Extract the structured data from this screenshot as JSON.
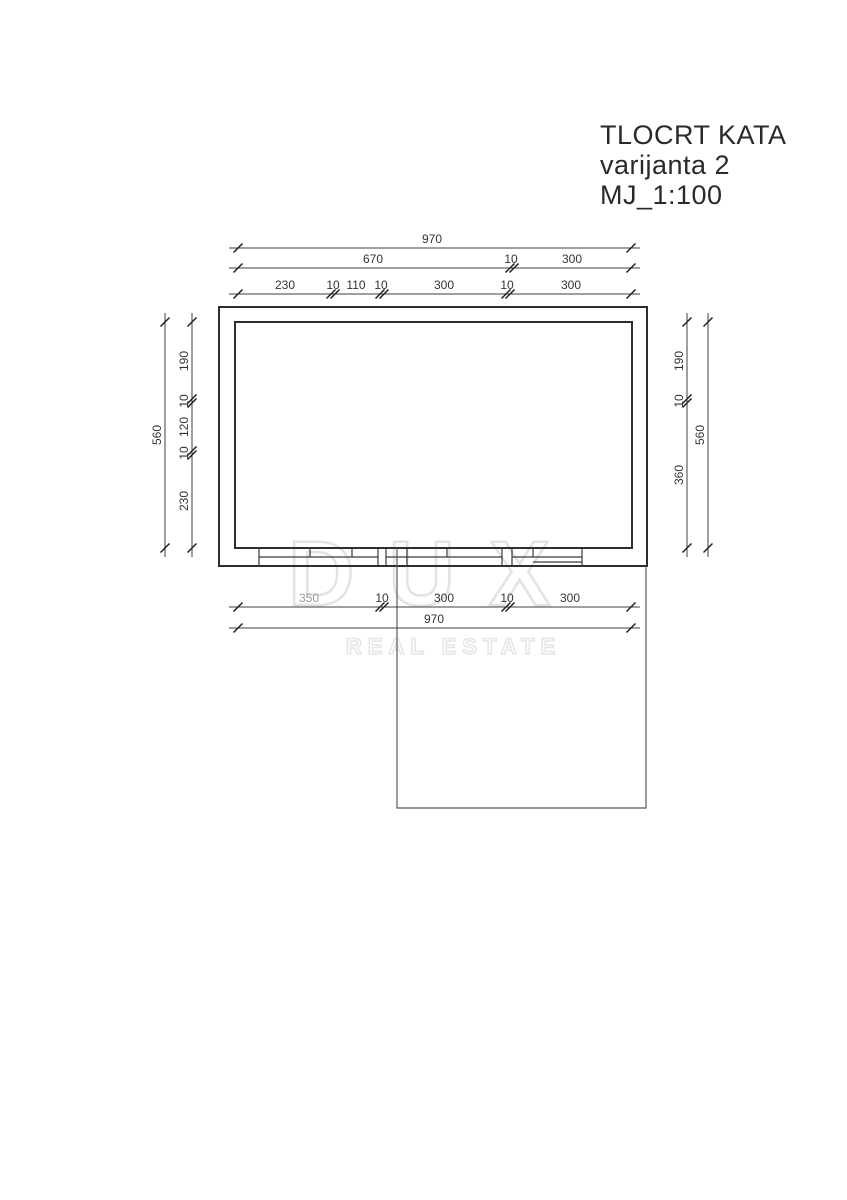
{
  "title_block": {
    "line1": "TLOCRT KATA",
    "line2": "varijanta 2",
    "line3": "MJ_1:100"
  },
  "watermark": {
    "logo_text": "DUX",
    "subtitle_text": "REAL ESTATE"
  },
  "dimensions": {
    "top_row1": {
      "total": "970"
    },
    "top_row2": {
      "segments": [
        "670",
        "10",
        "300"
      ]
    },
    "top_row3": {
      "segments": [
        "230",
        "10",
        "110",
        "10",
        "300",
        "10",
        "300"
      ]
    },
    "left_outer": {
      "total": "560"
    },
    "left_inner": {
      "segments": [
        "190",
        "10",
        "120",
        "10",
        "230"
      ]
    },
    "right_inner": {
      "segments": [
        "190",
        "10",
        "360"
      ]
    },
    "right_outer": {
      "total": "560"
    },
    "bottom_row1": {
      "segments": [
        "350",
        "10",
        "300",
        "10",
        "300"
      ]
    },
    "bottom_row2": {
      "total": "970"
    }
  },
  "colors": {
    "wall_line": "#2e2e2e",
    "dim_line": "#3f3f3f",
    "watermark": "#e3e3e3",
    "background": "#ffffff"
  }
}
